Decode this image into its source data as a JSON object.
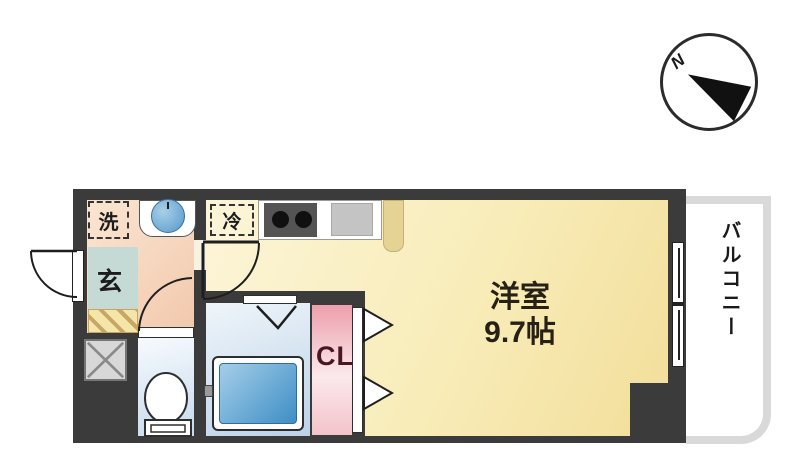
{
  "compass": {
    "north_label": "N"
  },
  "rooms": {
    "main": {
      "name": "洋室",
      "size": "9.7帖"
    },
    "balcony": {
      "label": "バルコニー"
    },
    "entrance": {
      "label": "玄"
    },
    "closet": {
      "label": "CL"
    }
  },
  "appliances": {
    "washer": {
      "label": "洗"
    },
    "refrigerator": {
      "label": "冷"
    }
  },
  "colors": {
    "wall": "#3b3b3b",
    "main_room": "#F8ECB8",
    "washroom": "#F5D7BF",
    "entrance": "#C5DAD4",
    "wet_room_blue": "#C6DAEE",
    "bathtub": "#3E8EC5",
    "closet_pink": "#EC9FAC",
    "balcony_border": "#D9D9D9"
  }
}
